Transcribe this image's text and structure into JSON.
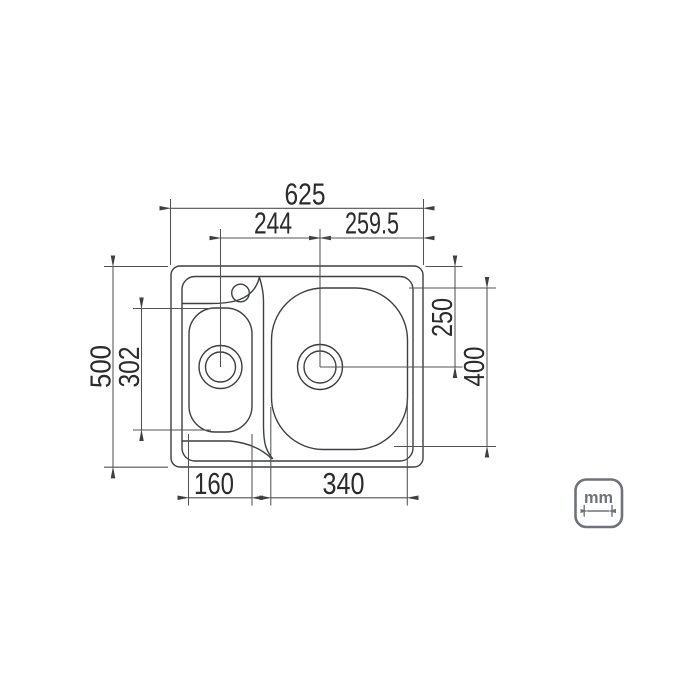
{
  "dimensions": {
    "top": {
      "overall_width": "625",
      "drain_spacing": "244",
      "drain_to_right_edge": "259.5"
    },
    "left": {
      "overall_depth": "500",
      "small_bowl_depth": "302"
    },
    "right": {
      "top_edge_to_drain_center": "250",
      "large_bowl_depth": "400"
    },
    "bottom": {
      "small_bowl_width": "160",
      "large_bowl_width": "340"
    }
  },
  "unit_badge": {
    "label": "mm"
  },
  "colors": {
    "object_line": "#3d3f42",
    "dimension_line": "#515356",
    "text": "#2b2b2b",
    "badge": "#6e7379",
    "background": "#ffffff"
  }
}
